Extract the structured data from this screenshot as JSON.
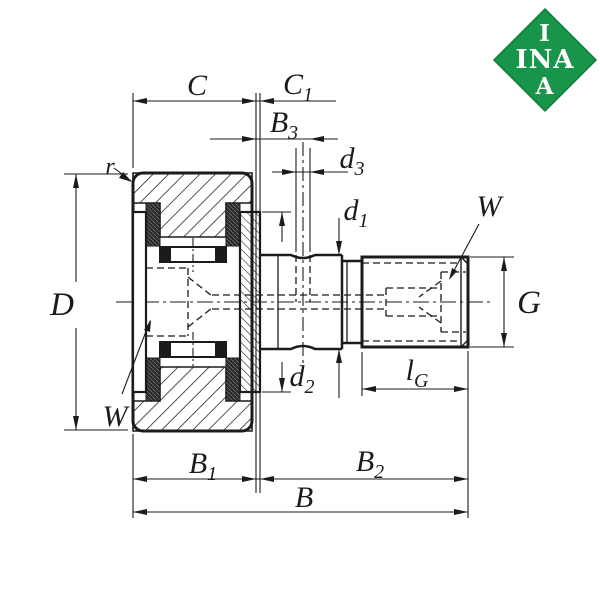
{
  "logo": {
    "line1": "I",
    "line2": "INA",
    "line3": "A",
    "bg_color": "#18954a",
    "border_color": "#0e7c38",
    "text_color": "#ffffff"
  },
  "colors": {
    "line": "#1b1b1b",
    "background": "#ffffff"
  },
  "labels": {
    "r": "r",
    "C": "C",
    "C1": {
      "main": "C",
      "sub": "1"
    },
    "B3": {
      "main": "B",
      "sub": "3"
    },
    "d3": {
      "main": "d",
      "sub": "3"
    },
    "d1": {
      "main": "d",
      "sub": "1"
    },
    "d2": {
      "main": "d",
      "sub": "2"
    },
    "W_right": "W",
    "W_left": "W",
    "D": "D",
    "G": "G",
    "lG": {
      "main": "l",
      "sub": "G"
    },
    "B1": {
      "main": "B",
      "sub": "1"
    },
    "B2": {
      "main": "B",
      "sub": "2"
    },
    "B": "B"
  }
}
